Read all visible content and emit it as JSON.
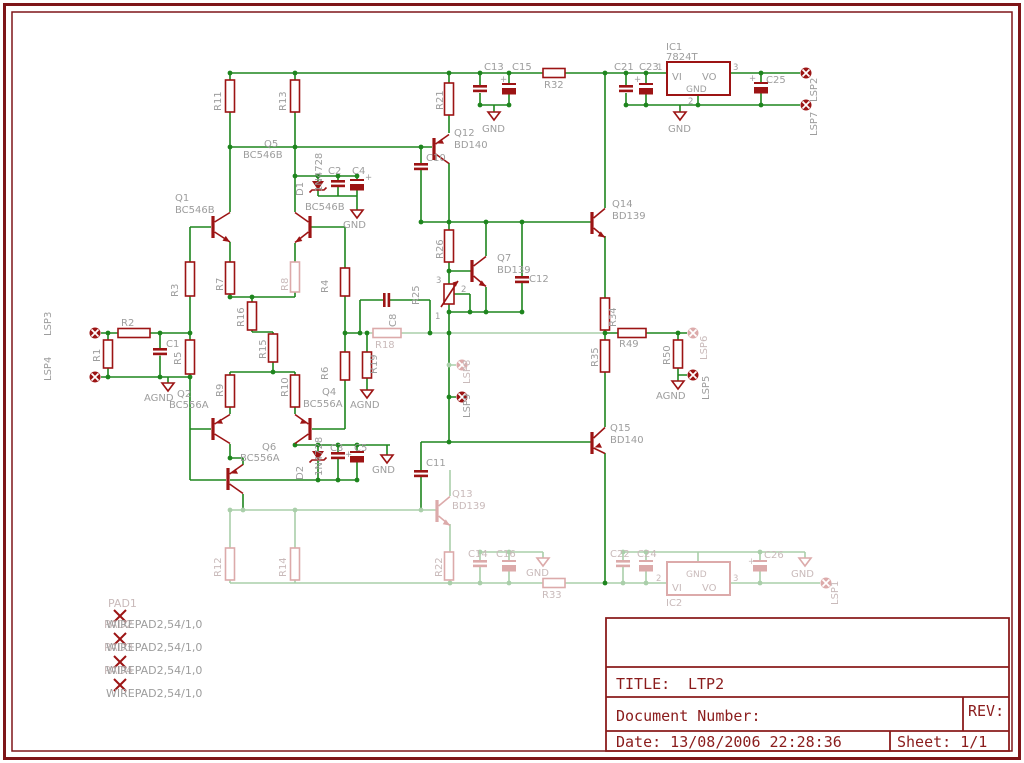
{
  "colors": {
    "wire_green": "#1e851e",
    "faded_green": "#aacfaa",
    "symbol_red": "#9c1414",
    "faded_red": "#dcaaaa",
    "label_gray": "#9d9d9d",
    "faded_label_gray": "#c9baba",
    "frame_maroon": "#7e1518"
  },
  "title_block": {
    "title_label": "TITLE:",
    "title_value": "LTP2",
    "doc_label": "Document Number:",
    "rev_label": "REV:",
    "date_label": "Date: 13/08/2006 22:28:36",
    "sheet_label": "Sheet: 1/1"
  },
  "t": {
    "ic1": "IC1",
    "ic1v": "7824T",
    "ic2": "IC2",
    "vi": "VI",
    "vo": "VO",
    "gnd": "GND",
    "agnd": "AGND",
    "plus": "+",
    "p1": "1",
    "p2": "2",
    "p3": "3",
    "r1": "R1",
    "r2": "R2",
    "r3": "R3",
    "r4": "R4",
    "r5": "R5",
    "r6": "R6",
    "r7": "R7",
    "r8": "R8",
    "r9": "R9",
    "r10": "R10",
    "r11": "R11",
    "r12": "R12",
    "r13": "R13",
    "r14": "R14",
    "r15": "R15",
    "r16": "R16",
    "r18": "R18",
    "r19": "R19",
    "r21": "R21",
    "r22": "R22",
    "r25": "R25",
    "r26": "R26",
    "r32": "R32",
    "r33": "R33",
    "r34": "R34",
    "r35": "R35",
    "r49": "R49",
    "r50": "R50",
    "c1": "C1",
    "c2": "C2",
    "c3": "C3",
    "c4": "C4",
    "c5": "C5",
    "c8": "C8",
    "c10": "C10",
    "c11": "C11",
    "c12": "C12",
    "c13": "C13",
    "c14": "C14",
    "c15": "C15",
    "c16": "C16",
    "c21": "C21",
    "c22": "C22",
    "c23": "C23",
    "c24": "C24",
    "c25": "C25",
    "c26": "C26",
    "q1": "Q1",
    "q2": "Q2",
    "q4": "Q4",
    "q5": "Q5",
    "q6": "Q6",
    "q7": "Q7",
    "q12": "Q12",
    "q13": "Q13",
    "q14": "Q14",
    "q15": "Q15",
    "bc546b": "BC546B",
    "bc556a": "BC556A",
    "bd139": "BD139",
    "bd140": "BD140",
    "d1": "D1",
    "d2": "D2",
    "zen": "1N4728",
    "lsp1": "LSP1",
    "lsp2": "LSP2",
    "lsp3": "LSP3",
    "lsp4": "LSP4",
    "lsp5": "LSP5",
    "lsp6": "LSP6",
    "lsp7": "LSP7",
    "lsp8": "LSP8",
    "lsp9": "LSP9",
    "pad1": "PAD1",
    "pad2": "PAD2",
    "pad3": "PAD3",
    "pad4": "PAD4",
    "wirepad": "WIREPAD2,54/1,0"
  }
}
